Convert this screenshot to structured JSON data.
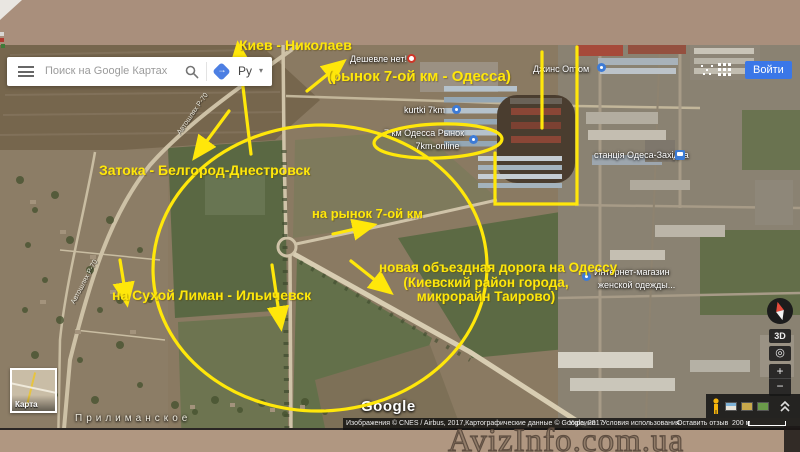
{
  "header": {
    "search_placeholder": "Поиск на Google Картах",
    "lang_button": "Ру",
    "signin_button": "Войти"
  },
  "map_controls": {
    "map_type_label": "Карта",
    "threed_label": "3D",
    "zoom_in": "+",
    "zoom_out": "−"
  },
  "map_labels": {
    "google_logo": "Google",
    "deshevle": "Дешевле нет!",
    "kurtki": "kurtki 7km",
    "rynok_line1": "7 км Одесса Рынок",
    "rynok_line2": "- 7km-online",
    "dzhins": "Джинс Оптом",
    "station": "станція Одеса-Західна",
    "internet_line1": "Интернет-магазин",
    "internet_line2": "женской одежды...",
    "town": "Прилиманское",
    "road_nw": "Автошлях Р-70",
    "road_sw": "Автошлях Р-70"
  },
  "annotations": {
    "accent_color": "#ffe70a",
    "kiev": "Киев - Николаев",
    "rynok_top": "(рынок 7-ой км - Одесса)",
    "zatoka": "Затока - Белгород-Днестровск",
    "na_rynok": "на рынок 7-ой км",
    "suhoj": "на Сухой Лиман - Ильичевск",
    "novaya_line1": "новая объездная дорога на Одессу",
    "novaya_line2": "(Киевский район города,",
    "novaya_line3": "микрорайн Таирово)"
  },
  "attribution": {
    "imagery": "Изображения © CNES / Airbus, 2017,Картографические данные © Google, 2017",
    "country": "Украина",
    "terms": "Условия использования",
    "feedback": "Оставить отзыв",
    "scale": "200 м"
  },
  "watermark": "AvizInfo.com.ua"
}
